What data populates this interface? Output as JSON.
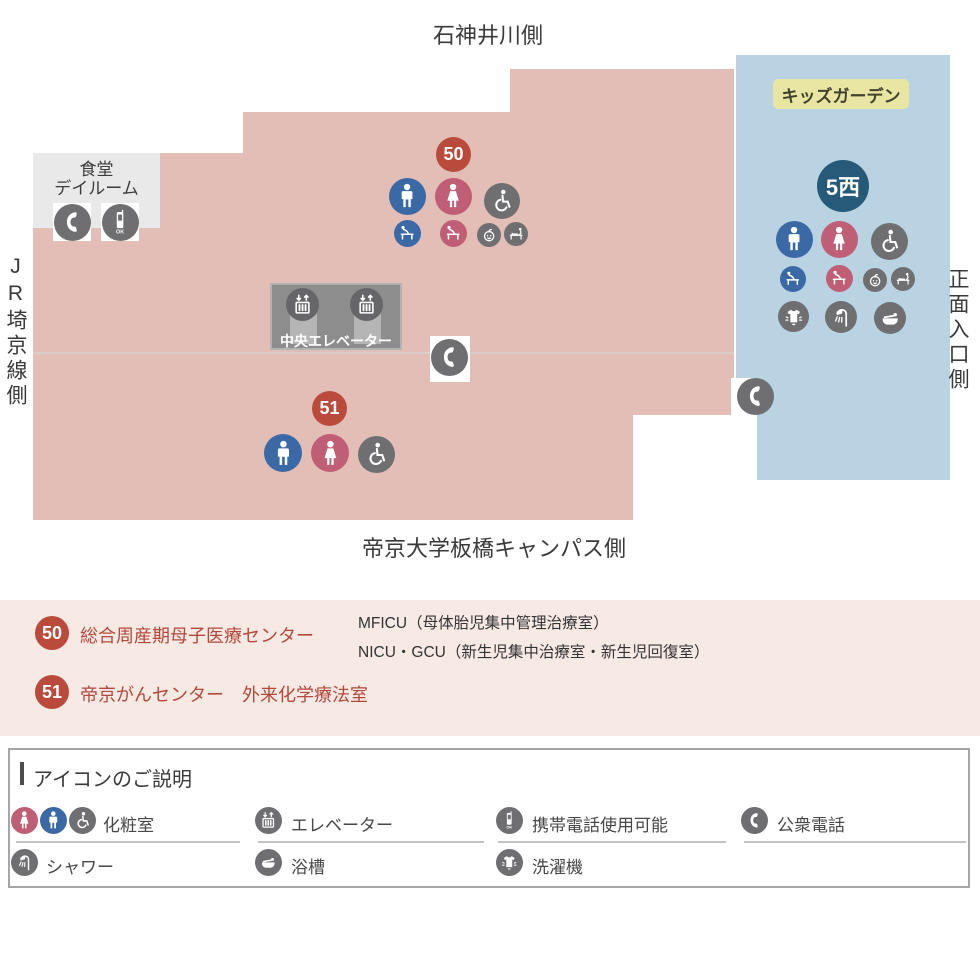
{
  "orientation_labels": {
    "top": "石神井川側",
    "left": "JR埼京線側",
    "right": "正面入口側",
    "bottom": "帝京大学板橋キャンパス側"
  },
  "map": {
    "dining_dayroom": {
      "line1": "食堂",
      "line2": "デイルーム"
    },
    "central_elevator": {
      "label": "中央エレベーター"
    },
    "kids_garden": {
      "label": "キッズガーデン"
    },
    "ward_5_west": {
      "label": "5西"
    },
    "area_50": {
      "badge": "50"
    },
    "area_51": {
      "badge": "51"
    },
    "mobile_phone_ok_text": "OK"
  },
  "area_legend": {
    "items": [
      {
        "badge": "50",
        "name": "総合周産期母子医療センター",
        "detail_lines": [
          "MFICU（母体胎児集中管理治療室）",
          "NICU・GCU（新生児集中治療室・新生児回復室）"
        ]
      },
      {
        "badge": "51",
        "name": "帝京がんセンター　外来化学療法室",
        "detail_lines": []
      }
    ]
  },
  "icon_guide": {
    "title": "アイコンのご説明",
    "row1": [
      {
        "icon": "restroom-icons",
        "label": "化粧室"
      },
      {
        "icon": "elevator-icon",
        "label": "エレベーター"
      },
      {
        "icon": "mobile-phone-icon",
        "label": "携帯電話使用可能"
      },
      {
        "icon": "public-phone-icon",
        "label": "公衆電話"
      }
    ],
    "row2": [
      {
        "icon": "shower-icon",
        "label": "シャワー"
      },
      {
        "icon": "bathtub-icon",
        "label": "浴槽"
      },
      {
        "icon": "washing-machine-icon",
        "label": "洗濯機"
      }
    ]
  },
  "palette": {
    "floor_pink": "#e3beb6",
    "floor_blue": "#b9d3e3",
    "legend_band_pink": "#f7e9e4",
    "badge_red": "#ba4a3c",
    "male_blue": "#3b69a5",
    "female_pink": "#c05e75",
    "icon_gray": "#6f6f71",
    "ward_navy": "#265a78",
    "kids_garden_yellow": "#e9e6a4"
  }
}
